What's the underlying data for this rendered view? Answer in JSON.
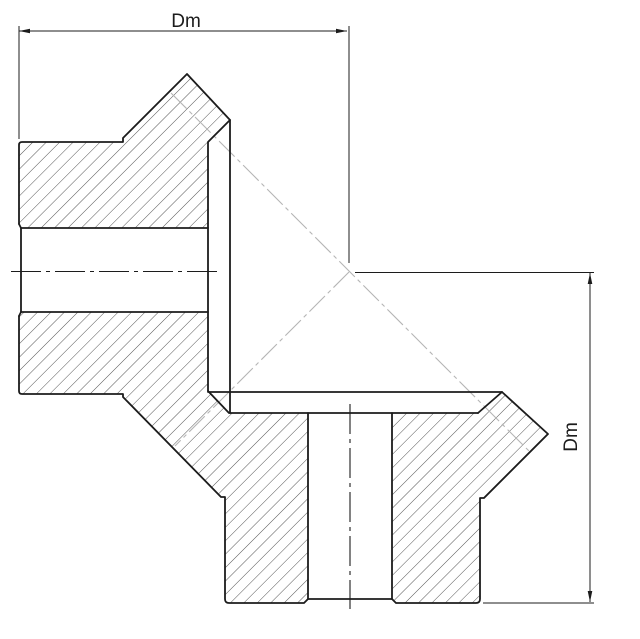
{
  "drawing": {
    "canvas": {
      "width": 640,
      "height": 639,
      "background": "#ffffff"
    },
    "colors": {
      "outline": "#1c1c1c",
      "thin": "#1c1c1c",
      "hatch": "#1c1c1c",
      "pitch_line": "#b5b5b5"
    },
    "stroke_widths": {
      "outline": 1.8,
      "thin": 1.0,
      "hatch": 0.75,
      "centerline": 1.1,
      "pitch": 1.1
    },
    "hatch": {
      "perpendicular_spacing": 9.5,
      "angle_deg": -45
    },
    "font_size": 19,
    "hatch_regions": [
      {
        "name": "left-gear-upper-section",
        "path": "M 19,224 L 19,145 Q 19,142 22,142 L 123,142 L 123,138 L 187,74 L 230,120 L 208,142 L 208,228 L 21,228 Z"
      },
      {
        "name": "left-gear-lower-and-bottom-gear-left-section",
        "path": "M 21,312 L 208,312 L 208,391 L 229,413 L 308,413 L 308,599 L 304,603 L 229,603 Q 225,603 225,599 L 225,497 L 221,497 L 123,397 L 123,394 L 22,394 Q 19,394 19,391 L 19,316 Z"
      },
      {
        "name": "bottom-gear-right-section",
        "path": "M 392,413 L 478,413 L 502,392 L 548,434 L 484,498 L 480,498 L 480,599 Q 480,603 476,603 L 396,603 L 392,599 Z"
      }
    ],
    "outlines": [
      {
        "name": "left-gear-upper-profile",
        "path": "M 19,224 L 19,145 Q 19,142 22,142 L 123,142 L 123,138 L 187,74 L 230,120 L 208,142 L 208,391"
      },
      {
        "name": "left-gear-outer-face-line",
        "path": "M 230,120 L 230,413"
      },
      {
        "name": "mesh-flank-and-root-line",
        "path": "M 208,391 L 229,413 L 478,413"
      },
      {
        "name": "bottom-gear-tip-line",
        "path": "M 208,392 L 502,392"
      },
      {
        "name": "left-gear-lower-profile-and-mesh-flank",
        "path": "M 19,316 L 19,391 Q 19,394 22,394 L 123,394 L 123,397 L 221,497 L 225,497 L 225,599 Q 225,603 229,603 L 304,603 L 308,599 L 308,413"
      },
      {
        "name": "left-gear-bore-top",
        "path": "M 21,228 L 208,228"
      },
      {
        "name": "left-gear-bore-bottom",
        "path": "M 21,312 L 208,312"
      },
      {
        "name": "left-gear-bore-end",
        "path": "M 21,228 L 21,312"
      },
      {
        "name": "left-gear-bore-chamfer-top",
        "path": "M 19,224 L 21,228"
      },
      {
        "name": "left-gear-bore-chamfer-bottom",
        "path": "M 19,316 L 21,312"
      },
      {
        "name": "bottom-gear-bore-end",
        "path": "M 308,599 L 392,599"
      },
      {
        "name": "bottom-gear-right-profile",
        "path": "M 392,413 L 392,599 L 396,603 L 476,603 Q 480,603 480,599 L 480,498 L 484,498 L 548,434 L 502,392 L 478,413"
      }
    ],
    "centerlines": [
      {
        "name": "left-gear-axis-centerline",
        "x1": 11,
        "y1": 271.5,
        "x2": 217,
        "y2": 271.5
      },
      {
        "name": "bottom-gear-axis-centerline",
        "x1": 350,
        "y1": 404,
        "x2": 350,
        "y2": 609
      }
    ],
    "pitch_lines": [
      {
        "name": "pitch-cone-line-main",
        "x1": 171,
        "y1": 93,
        "x2": 530,
        "y2": 452
      },
      {
        "name": "pitch-cone-line-mesh",
        "x1": 349,
        "y1": 272,
        "x2": 175,
        "y2": 446
      }
    ],
    "dimensions": {
      "top": {
        "label": "Dm",
        "line": {
          "x1": 19,
          "y1": 31,
          "x2": 347,
          "y2": 31
        },
        "arrows": [
          {
            "x": 19,
            "y": 31,
            "dir": "left"
          },
          {
            "x": 347,
            "y": 31,
            "dir": "right"
          }
        ],
        "extensions": [
          {
            "x1": 19,
            "y1": 26,
            "x2": 19,
            "y2": 139
          },
          {
            "x1": 349,
            "y1": 26,
            "x2": 349,
            "y2": 263
          }
        ],
        "label_x": 186,
        "label_y": 27,
        "rotate": 0
      },
      "right": {
        "label": "Dm",
        "line": {
          "x1": 590,
          "y1": 273,
          "x2": 590,
          "y2": 602
        },
        "arrows": [
          {
            "x": 590,
            "y": 273,
            "dir": "up"
          },
          {
            "x": 590,
            "y": 602,
            "dir": "down"
          }
        ],
        "extensions": [
          {
            "x1": 355,
            "y1": 272.5,
            "x2": 594,
            "y2": 272.5
          },
          {
            "x1": 483,
            "y1": 603,
            "x2": 594,
            "y2": 603
          }
        ],
        "label_x": 577,
        "label_y": 437,
        "rotate": -90
      }
    }
  }
}
